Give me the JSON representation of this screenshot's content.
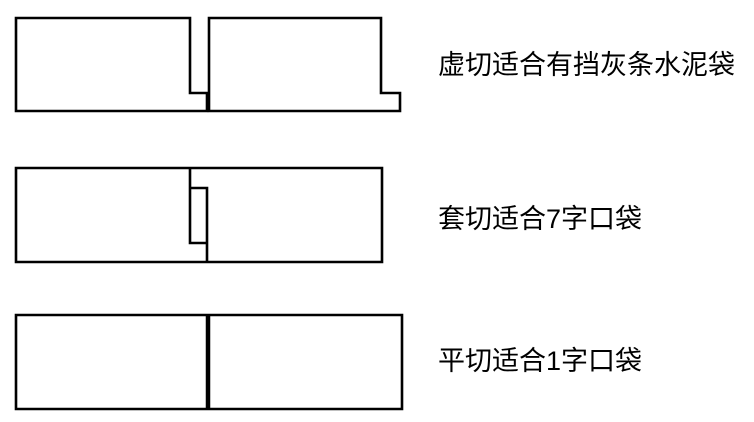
{
  "canvas": {
    "width": 754,
    "height": 422,
    "background_color": "#ffffff",
    "line_color": "#000000",
    "line_width": 2.6
  },
  "diagrams": [
    {
      "name": "xu-cut",
      "label": "虚切适合有挡灰条水泥袋",
      "shapes": [
        {
          "kind": "polygon",
          "role": "left-piece",
          "points": "16,18 190,18 190,93 207,93 207,111 16,111"
        },
        {
          "kind": "polygon",
          "role": "right-piece",
          "points": "209,18 381,18 381,93 400,93 400,111 209,111"
        }
      ]
    },
    {
      "name": "tao-cut",
      "label": "套切适合7字口袋",
      "shapes": [
        {
          "kind": "polygon",
          "role": "outer-rect",
          "points": "16,168 382,168 382,262 16,262"
        },
        {
          "kind": "polyline",
          "role": "cut-line-left",
          "points": "190,168 190,243 207,243"
        },
        {
          "kind": "polyline",
          "role": "cut-line-right",
          "points": "190,188 207,188 207,262"
        }
      ]
    },
    {
      "name": "ping-cut",
      "label": "平切适合1字口袋",
      "shapes": [
        {
          "kind": "polygon",
          "role": "outer-rect",
          "points": "16,315 402,315 402,409 16,409"
        },
        {
          "kind": "polyline",
          "role": "cut-line",
          "points": "208,315 208,409",
          "width": 4.5
        }
      ]
    }
  ]
}
